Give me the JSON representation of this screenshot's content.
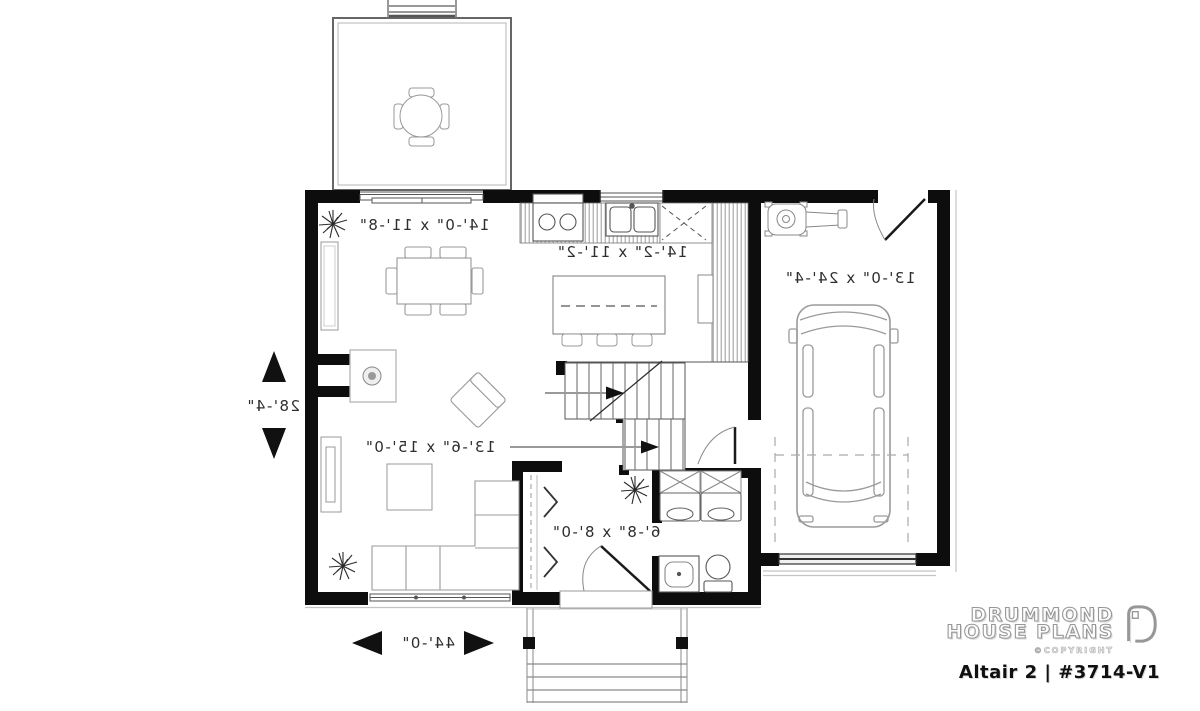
{
  "branding": {
    "brand_line1": "DRUMMOND",
    "brand_line2": "HOUSE PLANS",
    "copyright": "©COPYRIGHT",
    "plan_title": "Altair 2 | #3714-V1"
  },
  "labels": {
    "dining": "14'-0\" x 11'-8\"",
    "kitchen": "14'-2\" x 11'-2\"",
    "garage": "13'-0\" x 24'-4\"",
    "living": "13'-6\" x 15'-0\"",
    "entry": "6'-8\" x 8'-0\""
  },
  "overall_dimensions": {
    "width": "44'-0\"",
    "depth": "28'-4\""
  },
  "style": {
    "wall_color": "#0d0d0d",
    "furniture_line_color": "#979797",
    "label_color": "#2e2e2e",
    "logo_gray": "#979797"
  },
  "symbols": [
    "round-patio-table",
    "dining-table",
    "buffet",
    "kitchen-island",
    "bar-stools",
    "stove",
    "double-sink",
    "refrigerator",
    "corner-cabinet",
    "fireplace",
    "armchair",
    "sectional-sofa",
    "coffee-table",
    "tv-console",
    "staircase",
    "stair-arrows",
    "washer-dryer",
    "wall-cabinets",
    "toilet",
    "vanity-sink",
    "closet",
    "car",
    "lawnmower",
    "plant",
    "porch",
    "porch-steps",
    "garage-door",
    "front-door",
    "patio-slider",
    "windows"
  ]
}
